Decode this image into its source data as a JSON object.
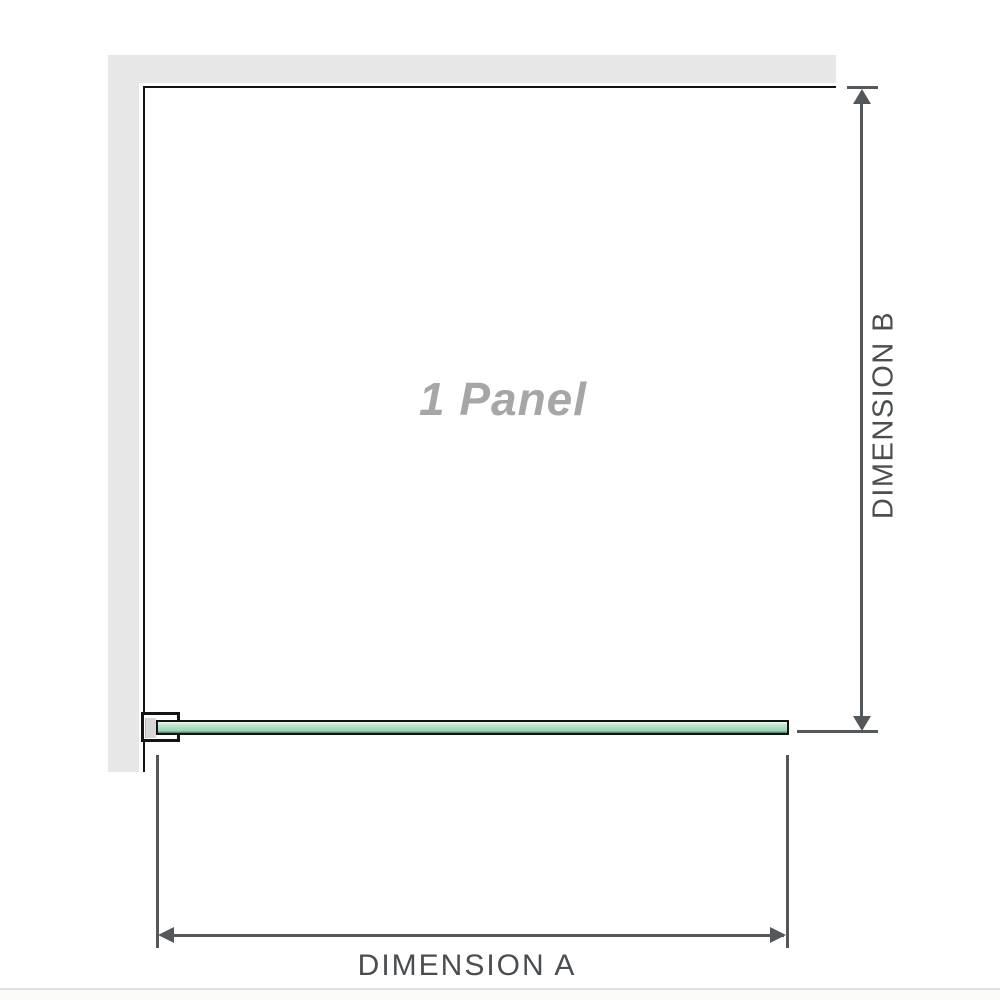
{
  "diagram": {
    "title": "Shower screen single panel dimension diagram",
    "panel_label": "1 Panel",
    "dimension_a_label": "DIMENSION A",
    "dimension_b_label": "DIMENSION B"
  },
  "icons": {
    "arrow_up": "dimension-b upper arrowhead",
    "arrow_down": "dimension-b lower arrowhead",
    "arrow_left": "dimension-a left arrowhead",
    "arrow_right": "dimension-a right arrowhead"
  },
  "colors": {
    "wall": "#e7e7e7",
    "outline": "#141414",
    "dim-line": "#55585a",
    "dim-text": "#4b4e50",
    "panel-text": "#a6a6a6",
    "divider": "#dfdfdf",
    "glass-hi": "#edf6f0",
    "glass-mid": "#a8dabe",
    "glass-dark": "#47745c"
  }
}
